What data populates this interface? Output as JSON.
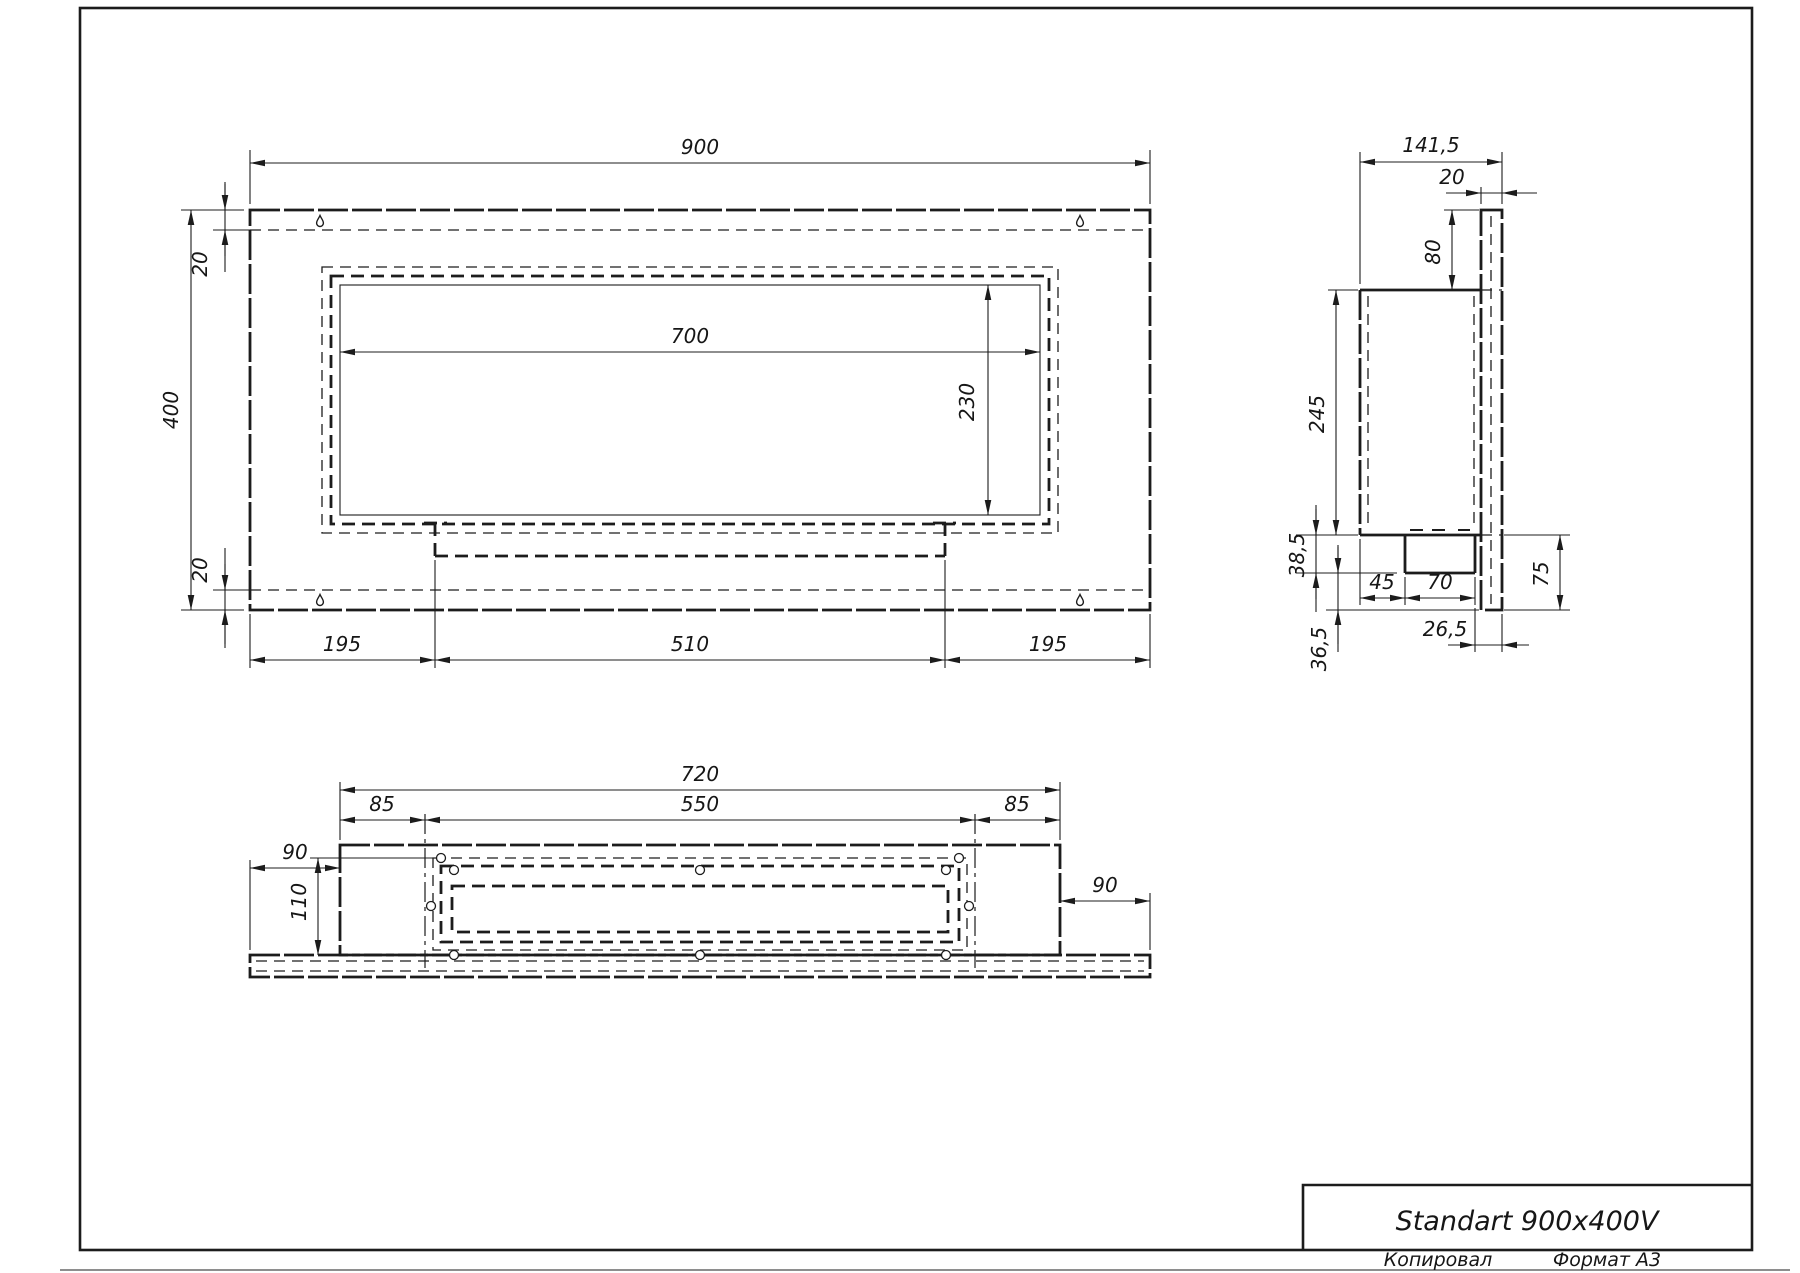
{
  "title_block": {
    "title": "Standart 900x400V",
    "copied_label": "Копировал",
    "format_label": "Формат А3"
  },
  "front_view": {
    "overall_width": "900",
    "overall_height": "400",
    "top_flange": "20",
    "bottom_flange": "20",
    "opening_width": "700",
    "opening_height": "230",
    "bottom_left": "195",
    "bottom_center": "510",
    "bottom_right": "195"
  },
  "side_view": {
    "overall_depth": "141,5",
    "back_panel_thickness": "20",
    "top_offset": "80",
    "body_height": "245",
    "tray_drop": "38,5",
    "tray_offset": "45",
    "tray_width": "70",
    "lower_height": "75",
    "tray_back_gap": "26,5",
    "bottom_gap": "36,5"
  },
  "bottom_view": {
    "box_width": "720",
    "left_margin": "85",
    "opening_width": "550",
    "right_margin": "85",
    "left_overhang": "90",
    "box_depth": "110",
    "right_overhang": "90"
  }
}
